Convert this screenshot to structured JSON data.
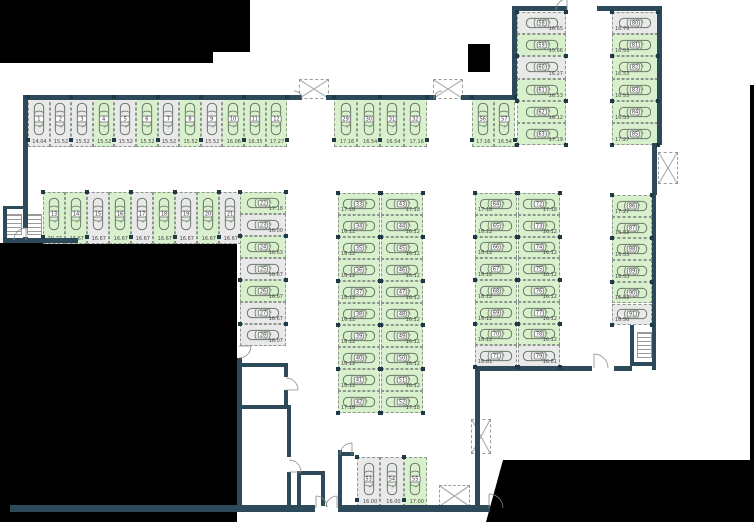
{
  "meta": {
    "view": "parking-garage-floor-plan",
    "total_stalls": 91,
    "free_stalls": 69,
    "occupied_stalls": 22
  },
  "legend": {
    "free_color": "#d8f0cb",
    "occupied_color": "#e9e9e9",
    "wall_color": "#2c4a5a",
    "outside_color": "#000000",
    "icons": [
      "car-icon",
      "door-swing-icon",
      "staircase-icon",
      "shaft-x-icon",
      "column-marker"
    ]
  },
  "stall_groups": [
    {
      "name": "top-row-west",
      "stalls": [
        {
          "no": "1",
          "area": "14.04",
          "status": "occupied"
        },
        {
          "no": "2",
          "area": "15.52",
          "status": "occupied"
        },
        {
          "no": "3",
          "area": "15.52",
          "status": "occupied"
        },
        {
          "no": "4",
          "area": "15.52",
          "status": "free"
        },
        {
          "no": "5",
          "area": "15.52",
          "status": "occupied"
        },
        {
          "no": "6",
          "area": "15.52",
          "status": "free"
        },
        {
          "no": "7",
          "area": "15.52",
          "status": "occupied"
        },
        {
          "no": "8",
          "area": "15.52",
          "status": "free"
        },
        {
          "no": "9",
          "area": "15.52",
          "status": "occupied"
        },
        {
          "no": "10",
          "area": "16.06",
          "status": "free"
        },
        {
          "no": "11",
          "area": "16.35",
          "status": "free"
        },
        {
          "no": "12",
          "area": "17.27",
          "status": "free"
        }
      ]
    },
    {
      "name": "top-row-middle",
      "stalls": [
        {
          "no": "29",
          "area": "17.16",
          "status": "free"
        },
        {
          "no": "30",
          "area": "16.54",
          "status": "free"
        },
        {
          "no": "31",
          "area": "16.54",
          "status": "free"
        },
        {
          "no": "32",
          "area": "17.16",
          "status": "free"
        }
      ]
    },
    {
      "name": "top-row-east",
      "stalls": [
        {
          "no": "56",
          "area": "17.16",
          "status": "free"
        },
        {
          "no": "57",
          "area": "16.54",
          "status": "free"
        }
      ]
    },
    {
      "name": "second-row",
      "stalls": [
        {
          "no": "13",
          "area": "20.27",
          "status": "free"
        },
        {
          "no": "14",
          "area": "16.67",
          "status": "free"
        },
        {
          "no": "15",
          "area": "16.67",
          "status": "occupied"
        },
        {
          "no": "16",
          "area": "16.67",
          "status": "free"
        },
        {
          "no": "17",
          "area": "16.67",
          "status": "occupied"
        },
        {
          "no": "18",
          "area": "16.67",
          "status": "free"
        },
        {
          "no": "19",
          "area": "16.67",
          "status": "occupied"
        },
        {
          "no": "20",
          "area": "16.67",
          "status": "free"
        },
        {
          "no": "21",
          "area": "16.67",
          "status": "occupied"
        }
      ]
    },
    {
      "name": "column-22-28",
      "stalls": [
        {
          "no": "22",
          "area": "17.18",
          "status": "free"
        },
        {
          "no": "23",
          "area": "16.00",
          "status": "occupied"
        },
        {
          "no": "24",
          "area": "16.63",
          "status": "free"
        },
        {
          "no": "25",
          "area": "16.67",
          "status": "occupied"
        },
        {
          "no": "26",
          "area": "16.67",
          "status": "free"
        },
        {
          "no": "27",
          "area": "16.67",
          "status": "occupied"
        },
        {
          "no": "28",
          "area": "16.07",
          "status": "occupied"
        }
      ]
    },
    {
      "name": "middle-left-column",
      "stalls": [
        {
          "no": "33",
          "area": "17.18",
          "status": "free"
        },
        {
          "no": "34",
          "area": "16.12",
          "status": "free"
        },
        {
          "no": "35",
          "area": "16.12",
          "status": "free"
        },
        {
          "no": "36",
          "area": "16.12",
          "status": "free"
        },
        {
          "no": "37",
          "area": "16.12",
          "status": "free"
        },
        {
          "no": "38",
          "area": "16.12",
          "status": "free"
        },
        {
          "no": "39",
          "area": "16.12",
          "status": "free"
        },
        {
          "no": "40",
          "area": "16.12",
          "status": "free"
        },
        {
          "no": "41",
          "area": "16.12",
          "status": "free"
        },
        {
          "no": "42",
          "area": "17.18",
          "status": "free"
        }
      ]
    },
    {
      "name": "middle-right-column",
      "stalls": [
        {
          "no": "43",
          "area": "17.18",
          "status": "free"
        },
        {
          "no": "44",
          "area": "16.12",
          "status": "free"
        },
        {
          "no": "45",
          "area": "16.12",
          "status": "free"
        },
        {
          "no": "46",
          "area": "16.12",
          "status": "free"
        },
        {
          "no": "47",
          "area": "16.12",
          "status": "free"
        },
        {
          "no": "48",
          "area": "16.12",
          "status": "free"
        },
        {
          "no": "49",
          "area": "16.12",
          "status": "free"
        },
        {
          "no": "50",
          "area": "16.12",
          "status": "free"
        },
        {
          "no": "51",
          "area": "16.12",
          "status": "free"
        },
        {
          "no": "52",
          "area": "17.18",
          "status": "free"
        }
      ]
    },
    {
      "name": "east-block-left-column",
      "stalls": [
        {
          "no": "64",
          "area": "17.18",
          "status": "free"
        },
        {
          "no": "65",
          "area": "16.12",
          "status": "free"
        },
        {
          "no": "66",
          "area": "16.12",
          "status": "free"
        },
        {
          "no": "67",
          "area": "16.12",
          "status": "free"
        },
        {
          "no": "68",
          "area": "16.12",
          "status": "free"
        },
        {
          "no": "69",
          "area": "16.12",
          "status": "free"
        },
        {
          "no": "70",
          "area": "16.12",
          "status": "free"
        },
        {
          "no": "71",
          "area": "16.81",
          "status": "occupied"
        }
      ]
    },
    {
      "name": "east-block-right-column",
      "stalls": [
        {
          "no": "72",
          "area": "17.18",
          "status": "free"
        },
        {
          "no": "73",
          "area": "16.12",
          "status": "free"
        },
        {
          "no": "74",
          "area": "16.12",
          "status": "free"
        },
        {
          "no": "75",
          "area": "16.12",
          "status": "free"
        },
        {
          "no": "76",
          "area": "16.12",
          "status": "free"
        },
        {
          "no": "77",
          "area": "16.12",
          "status": "free"
        },
        {
          "no": "78",
          "area": "16.12",
          "status": "free"
        },
        {
          "no": "79",
          "area": "16.81",
          "status": "occupied"
        }
      ]
    },
    {
      "name": "northeast-left-column",
      "stalls": [
        {
          "no": "58",
          "area": "16.65",
          "status": "occupied"
        },
        {
          "no": "59",
          "area": "15.66",
          "status": "free"
        },
        {
          "no": "60",
          "area": "16.27",
          "status": "occupied"
        },
        {
          "no": "61",
          "area": "16.53",
          "status": "free"
        },
        {
          "no": "62",
          "area": "16.12",
          "status": "free"
        },
        {
          "no": "63",
          "area": "17.19",
          "status": "free"
        }
      ]
    },
    {
      "name": "northeast-right-column",
      "stalls": [
        {
          "no": "80",
          "area": "16.79",
          "status": "occupied"
        },
        {
          "no": "81",
          "area": "16.53",
          "status": "free"
        },
        {
          "no": "82",
          "area": "16.53",
          "status": "free"
        },
        {
          "no": "83",
          "area": "16.53",
          "status": "free"
        },
        {
          "no": "84",
          "area": "16.53",
          "status": "free"
        },
        {
          "no": "85",
          "area": "17.27",
          "status": "free"
        }
      ]
    },
    {
      "name": "far-right-column",
      "stalls": [
        {
          "no": "86",
          "area": "17.27",
          "status": "free"
        },
        {
          "no": "87",
          "area": "16.53",
          "status": "free"
        },
        {
          "no": "88",
          "area": "16.53",
          "status": "free"
        },
        {
          "no": "89",
          "area": "16.53",
          "status": "free"
        },
        {
          "no": "90",
          "area": "16.53",
          "status": "free"
        },
        {
          "no": "91",
          "area": "16.56",
          "status": "occupied"
        }
      ]
    },
    {
      "name": "bottom-room",
      "stalls": [
        {
          "no": "53",
          "area": "16.00",
          "status": "occupied"
        },
        {
          "no": "54",
          "area": "16.00",
          "status": "occupied"
        },
        {
          "no": "55",
          "area": "17.00",
          "status": "free"
        }
      ]
    }
  ]
}
